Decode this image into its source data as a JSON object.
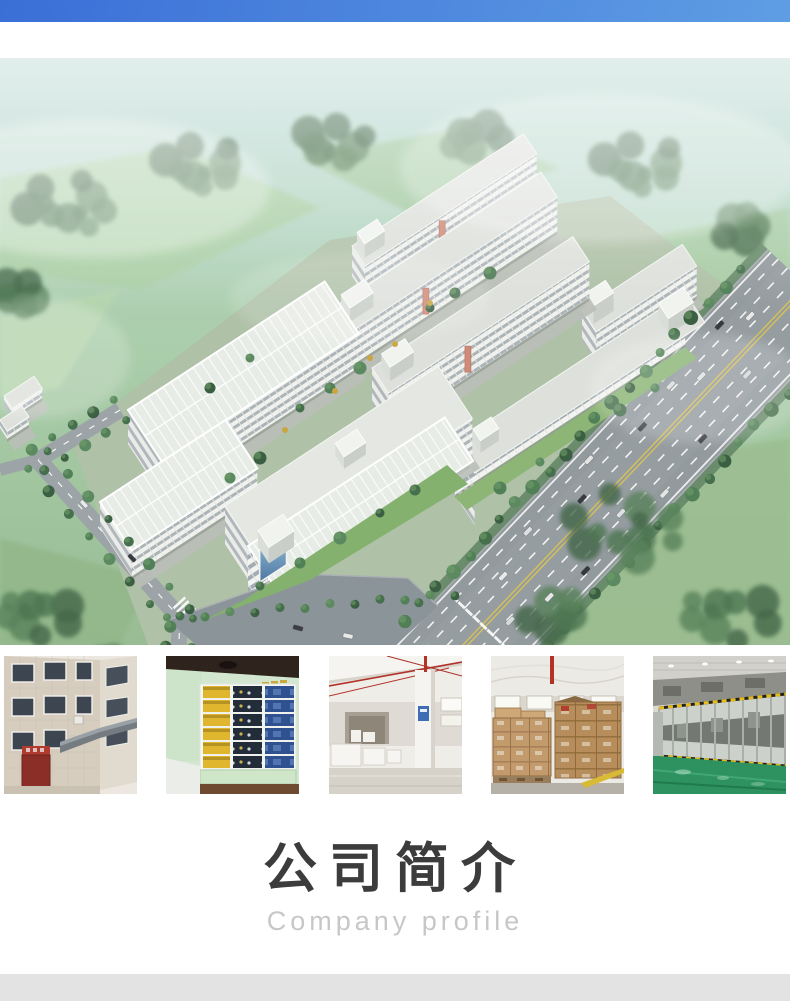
{
  "header": {
    "top_band_color_left": "#3a6fd7",
    "top_band_color_right": "#5f9de4"
  },
  "hero": {
    "name": "factory-campus-aerial-view"
  },
  "gallery": {
    "items": [
      {
        "name": "office-building-exterior"
      },
      {
        "name": "product-display-showroom"
      },
      {
        "name": "warehouse-interior"
      },
      {
        "name": "carton-stock-warehouse"
      },
      {
        "name": "production-line-workshop"
      }
    ]
  },
  "section": {
    "title": "公司简介",
    "subtitle": "Company profile"
  },
  "footer": {
    "bottom_band_color": "#e2e3e2"
  }
}
